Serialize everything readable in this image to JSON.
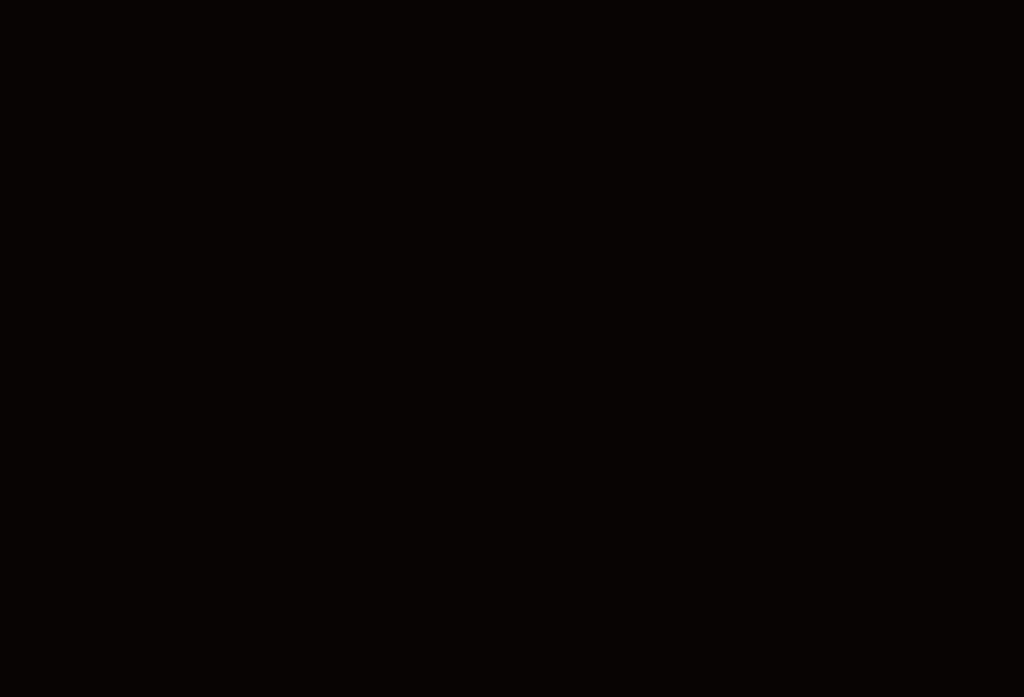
{
  "screen": {
    "background_color": "#080403",
    "style": "background-color:#080403;"
  }
}
